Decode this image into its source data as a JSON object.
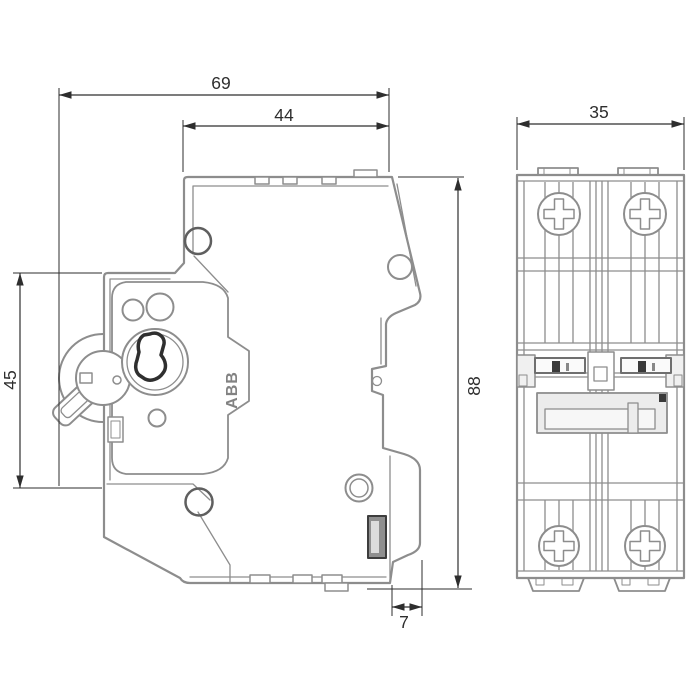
{
  "brand": "ABB",
  "dimensions": {
    "total_depth": "69",
    "body_depth": "44",
    "module_width": "35",
    "front_section_height": "45",
    "total_height": "88",
    "rail_clearance": "7"
  },
  "colors": {
    "outline_gray": "#8d8d8d",
    "dimension_dark": "#2e2e2e",
    "dark_detail": "#3a3a3a",
    "background": "#ffffff"
  }
}
